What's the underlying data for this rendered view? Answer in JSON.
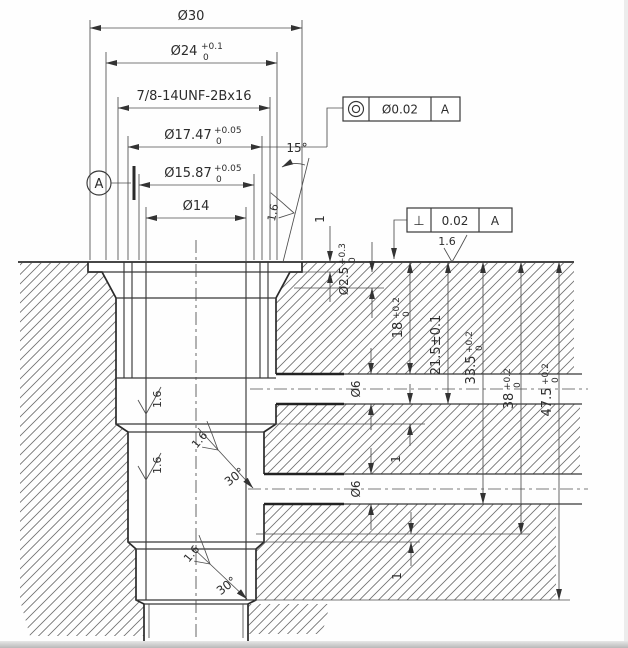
{
  "drawing": {
    "colors": {
      "line": "#2c2c2c",
      "background": "#fefefe"
    },
    "top_dims": {
      "d30": {
        "label": "Ø30"
      },
      "d24": {
        "label": "Ø24",
        "sup": "+0.1",
        "sub": "0"
      },
      "thread": {
        "label": "7/8-14UNF-2Bx16"
      },
      "d17_47": {
        "label": "Ø17.47",
        "sup": "+0.05",
        "sub": "0"
      },
      "d15_87": {
        "label": "Ø15.87",
        "sup": "+0.05",
        "sub": "0"
      },
      "d14": {
        "label": "Ø14"
      }
    },
    "right_dims": {
      "h18": {
        "label": "18",
        "sup": "+0.2",
        "sub": "0"
      },
      "h21_5": {
        "label": "21.5±0.1"
      },
      "h33_5": {
        "label": "33.5",
        "sup": "+0.2",
        "sub": "0"
      },
      "h38": {
        "label": "38",
        "sup": "+0.2",
        "sub": "0"
      },
      "h47_5": {
        "label": "47.5",
        "sup": "+0.2",
        "sub": "0"
      }
    },
    "side_dims": {
      "lip": {
        "label": "1"
      },
      "hole": {
        "label": "Ø2.5",
        "sup": "+0.3",
        "sub": "0"
      },
      "port1": {
        "label": "Ø6"
      },
      "port2": {
        "label": "Ø6"
      },
      "step1": {
        "label": "1"
      },
      "step2": {
        "label": "1"
      }
    },
    "angles": {
      "taper": "15°",
      "chamfer1": "30°",
      "chamfer2": "30°"
    },
    "finish": {
      "top": "1.6",
      "taper": "1.6",
      "bore1": "1.6",
      "bore2": "1.6",
      "chamfer1": "1.6",
      "chamfer2": "1.6"
    },
    "gdt": {
      "concentricity": {
        "symbol_icon": "concentricity-icon",
        "tol": "Ø0.02",
        "datum": "A"
      },
      "perpendicularity": {
        "symbol": "⊥",
        "tol": "0.02",
        "datum": "A"
      }
    },
    "datum": {
      "label": "A"
    }
  }
}
